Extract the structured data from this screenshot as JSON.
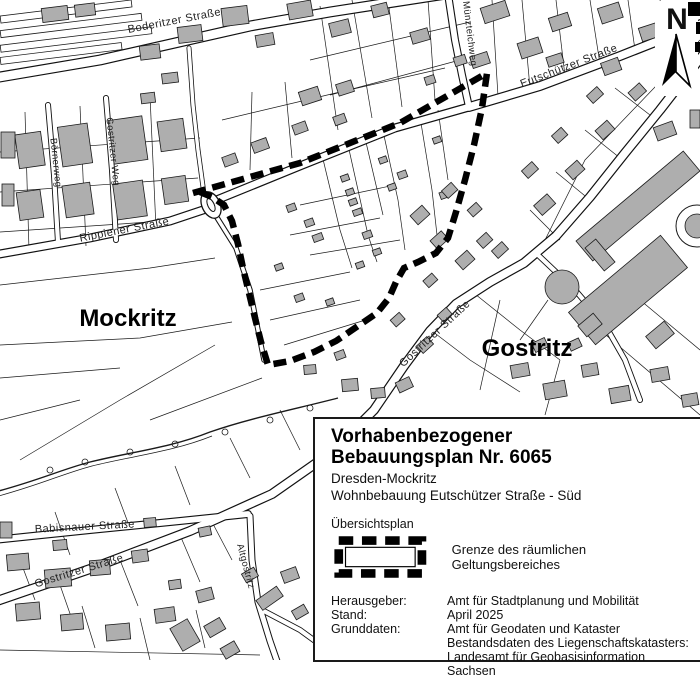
{
  "map": {
    "place_labels": {
      "west": "Mockritz",
      "east": "Gostritz"
    },
    "street_labels": {
      "boderitzer": {
        "text": "Boderitzer Straße"
      },
      "muenzteich": {
        "text": "Münzteichweg"
      },
      "eutschuetzer": {
        "text": "Eutschützer Straße"
      },
      "rippiener": {
        "text": "Rippiener Straße"
      },
      "boernerweg": {
        "text": "Börnerweg"
      },
      "gostritzerweg": {
        "text": "Gostritzer Weg"
      },
      "gostritzer_mid": {
        "text": "Gostritzer Straße"
      },
      "gostritzer_sw": {
        "text": "Gostritzer Straße"
      },
      "babisnauer": {
        "text": "Babisnauer Straße"
      },
      "altgostritz": {
        "text": "Altgostritz"
      }
    },
    "north_label": "N"
  },
  "legend": {
    "title_line1": "Vorhabenbezogener",
    "title_line2": "Bebauungsplan Nr. 6065",
    "subtitle1": "Dresden-Mockritz",
    "subtitle2": "Wohnbebauung Eutschützer Straße - Süd",
    "plan_type": "Übersichtsplan",
    "boundary_symbol_label": "Grenze des räumlichen Geltungsbereiches",
    "rows": [
      {
        "key": "Herausgeber:",
        "value": "Amt für Stadtplanung und Mobilität"
      },
      {
        "key": "Stand:",
        "value": "April 2025"
      },
      {
        "key": "Grunddaten:",
        "value": "Amt für Geodaten und Kataster"
      },
      {
        "key": "",
        "value": "Bestandsdaten des Liegenschaftskatasters:"
      },
      {
        "key": "",
        "value": "Landesamt für Geobasisinformation Sachsen"
      }
    ]
  },
  "colors": {
    "background": "#ffffff",
    "building_fill": "#aeaeae",
    "line": "#1a1a1a",
    "boundary": "#000000"
  }
}
